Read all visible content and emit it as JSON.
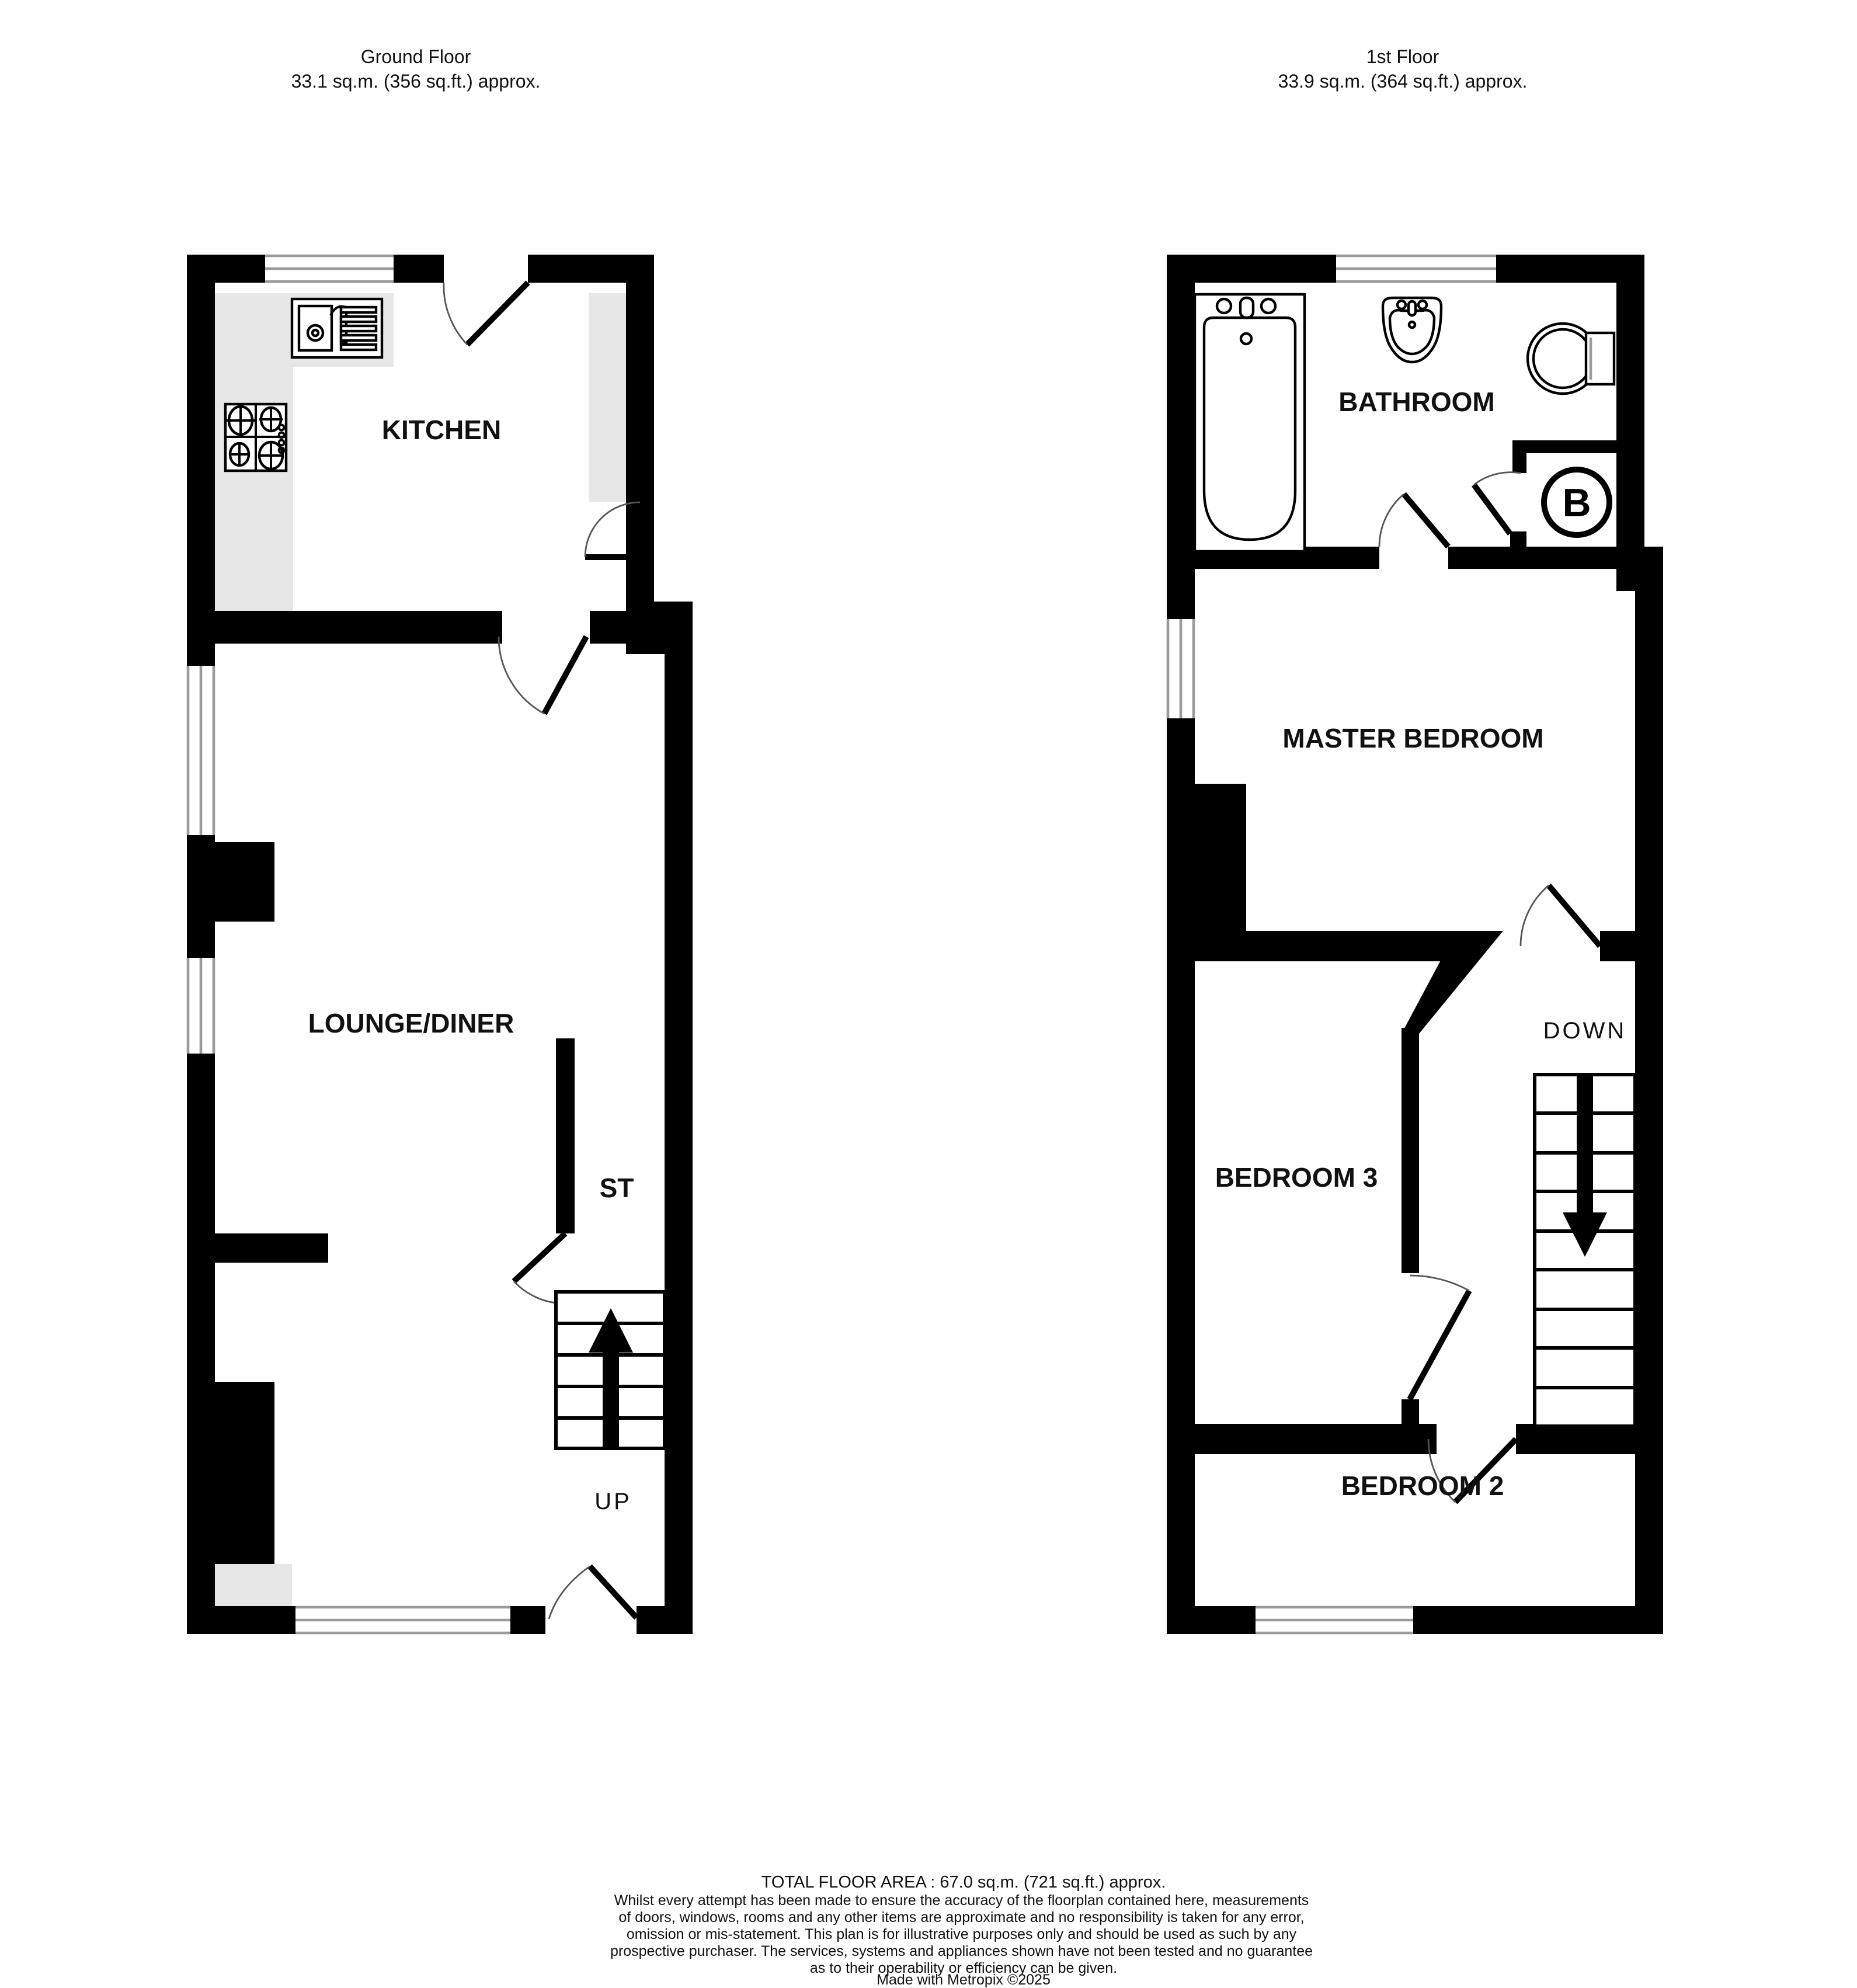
{
  "page": {
    "background": "#ffffff",
    "wall_color": "#000000",
    "counter_color": "#e7e7e7"
  },
  "ground_floor": {
    "title": "Ground Floor",
    "area": "33.1 sq.m. (356 sq.ft.) approx.",
    "kitchen_label": "KITCHEN",
    "lounge_label": "LOUNGE/DINER",
    "store_label": "ST",
    "stairs_label": "UP"
  },
  "first_floor": {
    "title": "1st Floor",
    "area": "33.9 sq.m. (364 sq.ft.) approx.",
    "bathroom_label": "BATHROOM",
    "master_label": "MASTER BEDROOM",
    "bedroom3_label": "BEDROOM 3",
    "bedroom2_label": "BEDROOM 2",
    "stairs_label": "DOWN",
    "boiler_label": "B"
  },
  "footer": {
    "total_area": "TOTAL FLOOR AREA : 67.0 sq.m. (721 sq.ft.) approx.",
    "disclaimer_lines": [
      "Whilst every attempt has been made to ensure the accuracy of the floorplan contained here, measurements",
      "of doors, windows, rooms and any other items are approximate and no responsibility is taken for any error,",
      "omission or mis-statement. This plan is for illustrative purposes only and should be used as such by any",
      "prospective purchaser. The services, systems and appliances shown have not been tested and no guarantee",
      "as to their operability or efficiency can be given."
    ],
    "credit": "Made with Metropix ©2025"
  }
}
